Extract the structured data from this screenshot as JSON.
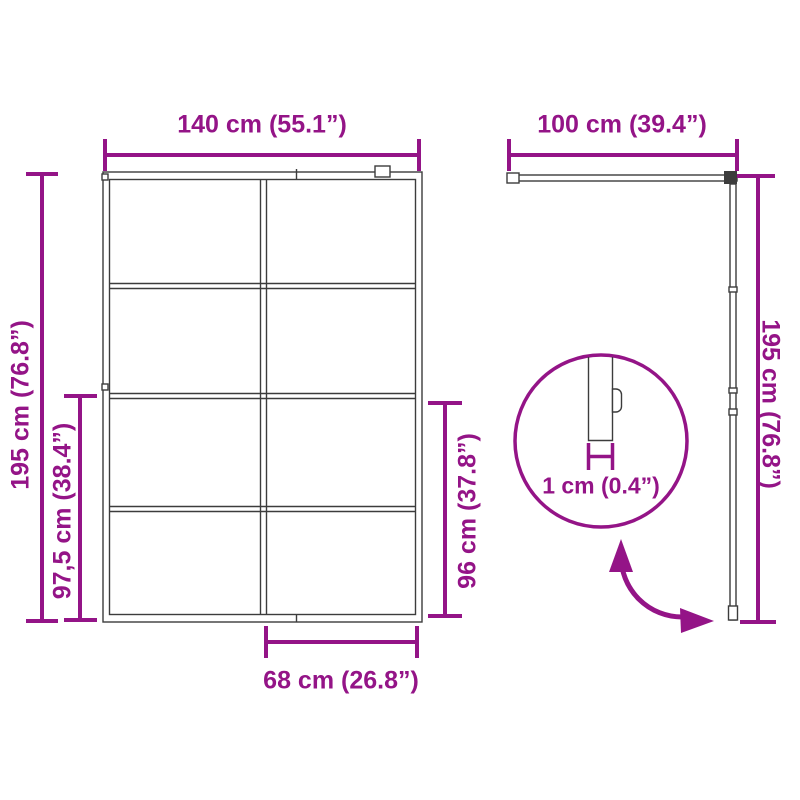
{
  "diagram": {
    "kind": "product-dimension-diagram",
    "subject": "sliding glass door with 8-pane front view, side track view and thickness detail",
    "accent_color": "#941487",
    "line_color": "#3c3c3c",
    "background_color": "#ffffff"
  },
  "labels": {
    "front_width": "140 cm (55.1”)",
    "track_width": "100 cm (39.4”)",
    "front_height": "195 cm (76.8”)",
    "side_height": "195 cm (76.8”)",
    "lower_section_height": "97,5 cm (38.4”)",
    "handle_height": "96 cm (37.8”)",
    "panel_width": "68 cm (26.8”)",
    "thickness": "1 cm (0.4”)"
  }
}
